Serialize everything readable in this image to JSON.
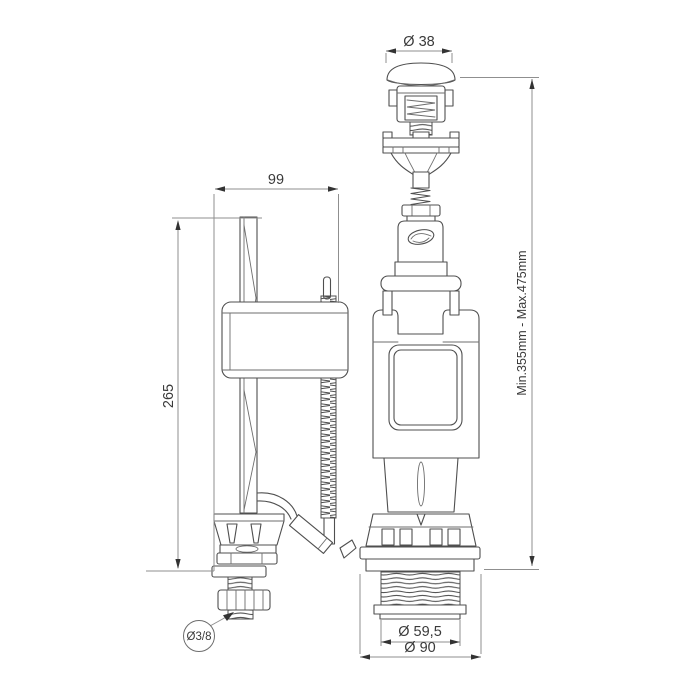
{
  "colors": {
    "background": "#ffffff",
    "part_line": "#4f4f4f",
    "dimension_line": "#8f8f8f",
    "dimension_text": "#3a3a3a"
  },
  "fill_valve": {
    "width_dim": "99",
    "height_dim": "265",
    "inlet_dim": "Ø3/8"
  },
  "flush_valve": {
    "button_dim": "Ø 38",
    "height_range_dim": "Min.355mm - Max.475mm",
    "thread_dim": "Ø 59,5",
    "flange_dim": "Ø 90"
  }
}
